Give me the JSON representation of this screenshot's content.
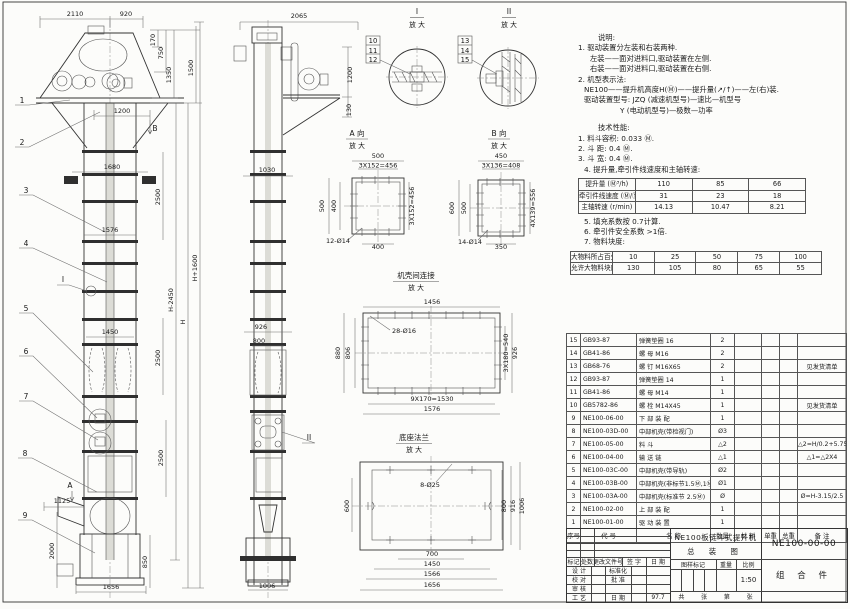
{
  "notes": {
    "title": "说明:",
    "n1": "1. 驱动装置分左装和右装两种.",
    "n2": "左装——面对进料口,驱动装置在左侧.",
    "n3": "右装——面对进料口,驱动装置在右侧.",
    "n4": "2. 机型表示法:",
    "n5": "NE100——提升机高度H(Ⓜ)——提升量(↗/↑)——左(右)装.",
    "n6": "驱动装置型号: JZQ (减速机型号)—速比—机型号",
    "n7": "Y (电动机型号)—极数—功率"
  },
  "tech": {
    "title": "技术性能:",
    "t1": "1. 料斗容积: 0.033 Ⓜ.",
    "t2": "2. 斗  距: 0.4 Ⓜ.",
    "t3": "3. 斗  宽: 0.4 Ⓜ.",
    "t4": "4. 提升量,牵引件线速度和主轴转速:",
    "t5": "5. 填充系数按 0.7计算.",
    "t6": "6. 牵引件安全系数 >1倍.",
    "t7": "7. 物料块度:",
    "perf_rows": [
      [
        "提升量 (Ⓜ³/h)",
        "110",
        "85",
        "66"
      ],
      [
        "牵引件线速度 (Ⓜ/Ⓢ)",
        "31",
        "23",
        "18"
      ],
      [
        "主轴转速 (r/min)",
        "14.13",
        "10.47",
        "8.21"
      ]
    ],
    "lump_rows": [
      [
        "大物料所占百分比 (%)",
        "10",
        "25",
        "50",
        "75",
        "100"
      ],
      [
        "允许大物料块度 (ⓂⓂ)",
        "130",
        "105",
        "80",
        "65",
        "55"
      ]
    ]
  },
  "parts": {
    "header": [
      "序号",
      "代  号",
      "名  称",
      "数量",
      "材  料",
      "单重",
      "总重",
      "备  注"
    ],
    "rows": [
      [
        "15",
        "GB93-87",
        "弹簧垫圈 16",
        "2",
        "",
        "",
        "",
        ""
      ],
      [
        "14",
        "GB41-86",
        "螺 母  M16",
        "2",
        "",
        "",
        "",
        ""
      ],
      [
        "13",
        "GB68-76",
        "螺 钉  M16X65",
        "2",
        "",
        "",
        "",
        "见发货清单"
      ],
      [
        "12",
        "GB93-87",
        "弹簧垫圈 14",
        "1",
        "",
        "",
        "",
        ""
      ],
      [
        "11",
        "GB41-86",
        "螺 母  M14",
        "1",
        "",
        "",
        "",
        ""
      ],
      [
        "10",
        "GB5782-86",
        "螺 栓  M14X45",
        "1",
        "",
        "",
        "",
        "见发货清单"
      ],
      [
        "9",
        "NE100-06-00",
        "下 部 装 配",
        "1",
        "",
        "",
        "",
        ""
      ],
      [
        "8",
        "NE100-03D-00",
        "中部机壳(带检视门)",
        "Ø3",
        "",
        "",
        "",
        ""
      ],
      [
        "7",
        "NE100-05-00",
        "料 斗",
        "△2",
        "",
        "",
        "",
        "△2=H/0.2+5.75"
      ],
      [
        "6",
        "NE100-04-00",
        "输 送 链",
        "△1",
        "",
        "",
        "",
        "△1=△2X4"
      ],
      [
        "5",
        "NE100-03C-00",
        "中部机壳(带导轨)",
        "Ø2",
        "",
        "",
        "",
        ""
      ],
      [
        "4",
        "NE100-03B-00",
        "中部机壳(非标节1.5Ⓜ,1Ⓜ)",
        "Ø1",
        "",
        "",
        "",
        ""
      ],
      [
        "3",
        "NE100-03A-00",
        "中部机壳(标准节 2.5Ⓜ)",
        "Ø",
        "",
        "",
        "",
        "Ø=H-3.15/2.5"
      ],
      [
        "2",
        "NE100-02-00",
        "上 部 装 配",
        "1",
        "",
        "",
        "",
        ""
      ],
      [
        "1",
        "NE100-01-00",
        "驱 动 装 置",
        "1",
        "",
        "",
        "",
        ""
      ]
    ]
  },
  "titleblock": {
    "title_line1": "NE100板链斗式提升机",
    "title_line2": "总 装 图",
    "drawing_no": "NE100-00-00",
    "part_type": "组 合 件",
    "rev1": "标记",
    "rev2": "处数",
    "rev3": "更改文件号",
    "rev4": "签 字",
    "rev5": "日 期",
    "role_design": "设 计",
    "role_check": "校 对",
    "role_audit": "审 核",
    "role_process": "工 艺",
    "role_std": "标准化",
    "role_approve": "批 准",
    "role_date": "日 期",
    "date": "97.7",
    "stamp1": "图样标记",
    "stamp2": "重量",
    "stamp3": "比例",
    "scale": "1:50",
    "sheet1": "共",
    "sheet2": "张",
    "sheet3": "第",
    "sheet4": "张"
  },
  "drawing": {
    "labels": [
      {
        "t": "2110",
        "x": 75,
        "y": 16
      },
      {
        "t": "920",
        "x": 126,
        "y": 16
      },
      {
        "t": "170",
        "x": 155,
        "y": 40,
        "r": -90
      },
      {
        "t": "750",
        "x": 163,
        "y": 53,
        "r": -90
      },
      {
        "t": "1350",
        "x": 171,
        "y": 75,
        "r": -90
      },
      {
        "t": "1500",
        "x": 193,
        "y": 68,
        "r": -90
      },
      {
        "t": "1200",
        "x": 122,
        "y": 113
      },
      {
        "t": "B",
        "x": 155,
        "y": 131,
        "c": "marker"
      },
      {
        "t": "1680",
        "x": 112,
        "y": 169
      },
      {
        "t": "2500",
        "x": 160,
        "y": 197,
        "r": -90
      },
      {
        "t": "1576",
        "x": 110,
        "y": 232
      },
      {
        "t": "H+1600",
        "x": 197,
        "y": 268,
        "r": -90
      },
      {
        "t": "H-2450",
        "x": 173,
        "y": 300,
        "r": -90
      },
      {
        "t": "H",
        "x": 185,
        "y": 322,
        "r": -90
      },
      {
        "t": "1450",
        "x": 110,
        "y": 334
      },
      {
        "t": "2500",
        "x": 160,
        "y": 358,
        "r": -90
      },
      {
        "t": "2500",
        "x": 163,
        "y": 458,
        "r": -90
      },
      {
        "t": "I",
        "x": 63,
        "y": 282,
        "c": "marker"
      },
      {
        "t": "A",
        "x": 70,
        "y": 488,
        "c": "marker"
      },
      {
        "t": "1125",
        "x": 62,
        "y": 503
      },
      {
        "t": "2000",
        "x": 54,
        "y": 551,
        "r": -90
      },
      {
        "t": "850",
        "x": 147,
        "y": 562,
        "r": -90
      },
      {
        "t": "1656",
        "x": 111,
        "y": 589
      },
      {
        "t": "1",
        "x": 22,
        "y": 103,
        "c": "balloon"
      },
      {
        "t": "2",
        "x": 22,
        "y": 145,
        "c": "balloon"
      },
      {
        "t": "3",
        "x": 26,
        "y": 193,
        "c": "balloon"
      },
      {
        "t": "4",
        "x": 26,
        "y": 246,
        "c": "balloon"
      },
      {
        "t": "5",
        "x": 26,
        "y": 311,
        "c": "balloon"
      },
      {
        "t": "6",
        "x": 26,
        "y": 354,
        "c": "balloon"
      },
      {
        "t": "7",
        "x": 26,
        "y": 399,
        "c": "balloon"
      },
      {
        "t": "8",
        "x": 25,
        "y": 456,
        "c": "balloon"
      },
      {
        "t": "9",
        "x": 25,
        "y": 518,
        "c": "balloon"
      },
      {
        "t": "2065",
        "x": 299,
        "y": 18
      },
      {
        "t": "1200",
        "x": 352,
        "y": 75,
        "r": -90
      },
      {
        "t": "130",
        "x": 351,
        "y": 110,
        "r": -90
      },
      {
        "t": "1030",
        "x": 267,
        "y": 172
      },
      {
        "t": "926",
        "x": 261,
        "y": 329
      },
      {
        "t": "800",
        "x": 259,
        "y": 343
      },
      {
        "t": "II",
        "x": 309,
        "y": 440,
        "c": "marker"
      },
      {
        "t": "1006",
        "x": 267,
        "y": 588
      },
      {
        "t": "I",
        "x": 417,
        "y": 14,
        "c": "dtitle"
      },
      {
        "t": "放 大",
        "x": 417,
        "y": 27,
        "c": "dsub"
      },
      {
        "t": "II",
        "x": 509,
        "y": 14,
        "c": "dtitle"
      },
      {
        "t": "放 大",
        "x": 509,
        "y": 27,
        "c": "dsub"
      },
      {
        "t": "10",
        "x": 373,
        "y": 43,
        "c": "boxn"
      },
      {
        "t": "11",
        "x": 373,
        "y": 53,
        "c": "boxn"
      },
      {
        "t": "12",
        "x": 373,
        "y": 62,
        "c": "boxn"
      },
      {
        "t": "13",
        "x": 465,
        "y": 43,
        "c": "boxn"
      },
      {
        "t": "14",
        "x": 465,
        "y": 53,
        "c": "boxn"
      },
      {
        "t": "15",
        "x": 465,
        "y": 62,
        "c": "boxn"
      },
      {
        "t": "A 向",
        "x": 357,
        "y": 136,
        "c": "dtitle"
      },
      {
        "t": "放 大",
        "x": 357,
        "y": 148,
        "c": "dsub"
      },
      {
        "t": "B 向",
        "x": 499,
        "y": 136,
        "c": "dtitle"
      },
      {
        "t": "放 大",
        "x": 499,
        "y": 148,
        "c": "dsub"
      },
      {
        "t": "500",
        "x": 378,
        "y": 158
      },
      {
        "t": "3X152=456",
        "x": 378,
        "y": 167.5
      },
      {
        "t": "500",
        "x": 324,
        "y": 206,
        "r": -90
      },
      {
        "t": "400",
        "x": 336,
        "y": 206,
        "r": -90
      },
      {
        "t": "3X152=456",
        "x": 414,
        "y": 206,
        "r": -90
      },
      {
        "t": "400",
        "x": 378,
        "y": 249
      },
      {
        "t": "12-Ø14",
        "x": 338,
        "y": 243
      },
      {
        "t": "450",
        "x": 501,
        "y": 158
      },
      {
        "t": "3X136=408",
        "x": 501,
        "y": 167.5
      },
      {
        "t": "600",
        "x": 454,
        "y": 208,
        "r": -90
      },
      {
        "t": "500",
        "x": 466,
        "y": 208,
        "r": -90
      },
      {
        "t": "4X139=556",
        "x": 535,
        "y": 208,
        "r": -90
      },
      {
        "t": "350",
        "x": 501,
        "y": 249
      },
      {
        "t": "14-Ø14",
        "x": 470,
        "y": 244
      },
      {
        "t": "机壳间连接",
        "x": 416,
        "y": 278,
        "c": "dtitle"
      },
      {
        "t": "放 大",
        "x": 416,
        "y": 290,
        "c": "dsub"
      },
      {
        "t": "1456",
        "x": 432,
        "y": 304
      },
      {
        "t": "28-Ø16",
        "x": 404,
        "y": 333
      },
      {
        "t": "880",
        "x": 340,
        "y": 353,
        "r": -90
      },
      {
        "t": "806",
        "x": 350,
        "y": 353,
        "r": -90
      },
      {
        "t": "3X180=540",
        "x": 508,
        "y": 353,
        "r": -90
      },
      {
        "t": "926",
        "x": 517,
        "y": 353,
        "r": -90
      },
      {
        "t": "9X170=1530",
        "x": 432,
        "y": 401
      },
      {
        "t": "1576",
        "x": 432,
        "y": 411
      },
      {
        "t": "底座法兰",
        "x": 414,
        "y": 440,
        "c": "dtitle"
      },
      {
        "t": "放 大",
        "x": 414,
        "y": 452,
        "c": "dsub"
      },
      {
        "t": "8-Ø25",
        "x": 430,
        "y": 487
      },
      {
        "t": "600",
        "x": 349,
        "y": 506,
        "r": -90
      },
      {
        "t": "800",
        "x": 506,
        "y": 506,
        "r": -90
      },
      {
        "t": "916",
        "x": 515,
        "y": 506,
        "r": -90
      },
      {
        "t": "1006",
        "x": 524,
        "y": 506,
        "r": -90
      },
      {
        "t": "700",
        "x": 432,
        "y": 556
      },
      {
        "t": "1450",
        "x": 432,
        "y": 566
      },
      {
        "t": "1566",
        "x": 432,
        "y": 576
      },
      {
        "t": "1656",
        "x": 432,
        "y": 587
      }
    ]
  }
}
